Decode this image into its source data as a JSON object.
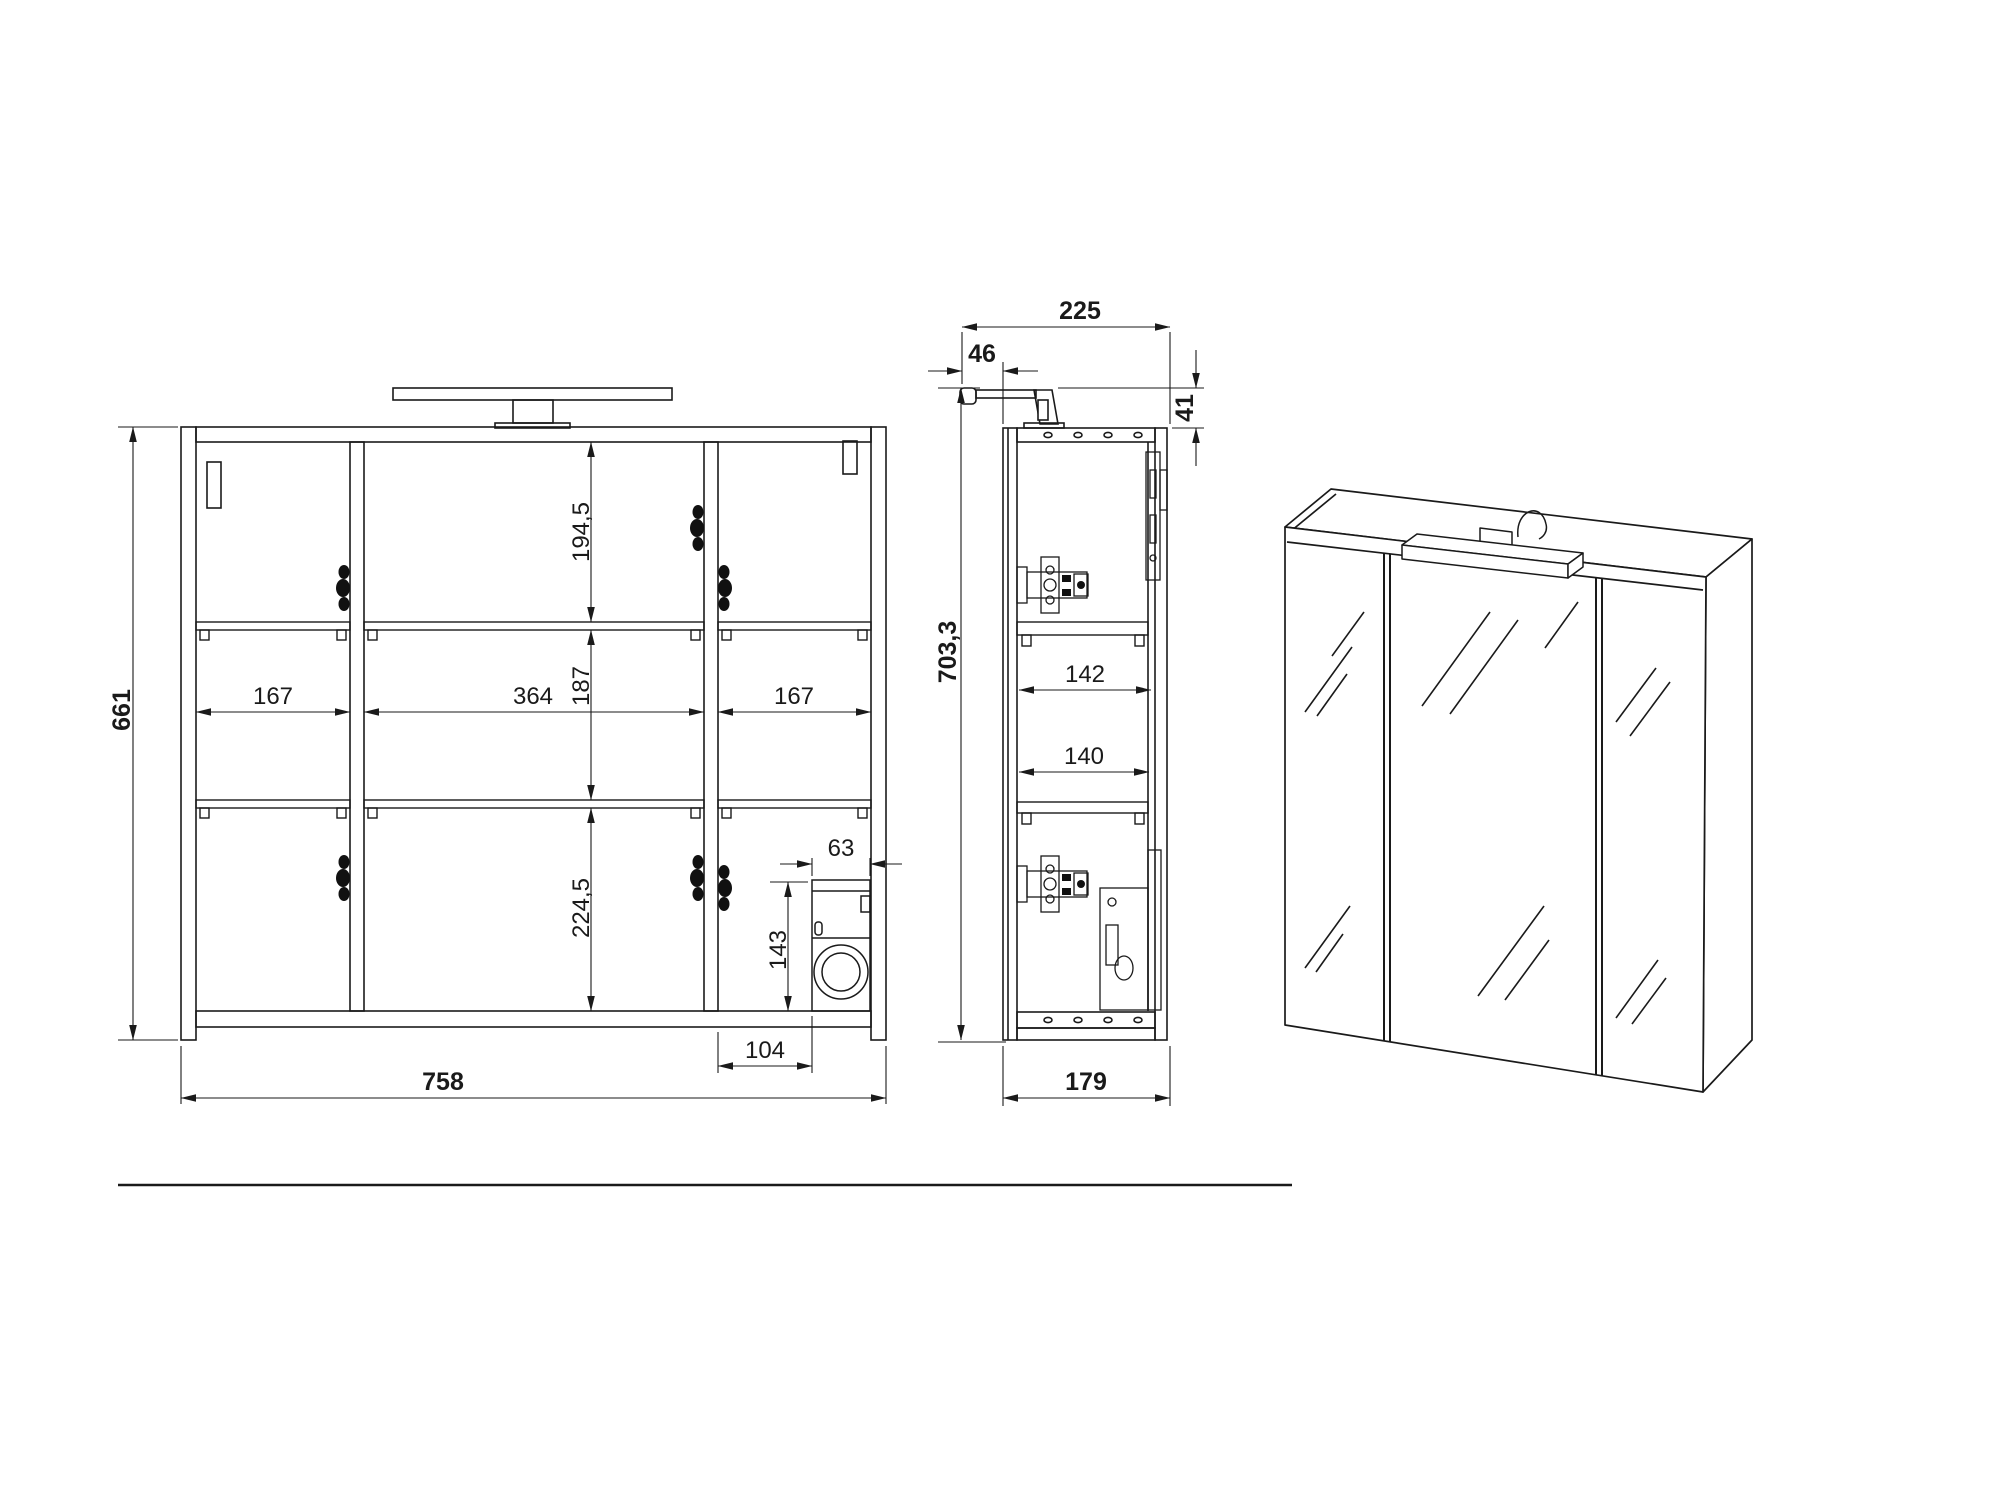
{
  "front_view": {
    "height": "661",
    "width": "758",
    "top_section": "194,5",
    "middle_section": "187",
    "bottom_section": "224,5",
    "left_width": "167",
    "center_width": "364",
    "right_width": "167",
    "box_width": "63",
    "box_height": "143",
    "box_offset": "104"
  },
  "side_view": {
    "depth_with_light": "225",
    "light_overhang": "46",
    "light_above_top": "41",
    "height_with_light": "703,3",
    "upper_shelf_depth": "142",
    "lower_shelf_depth": "140",
    "body_depth": "179"
  }
}
